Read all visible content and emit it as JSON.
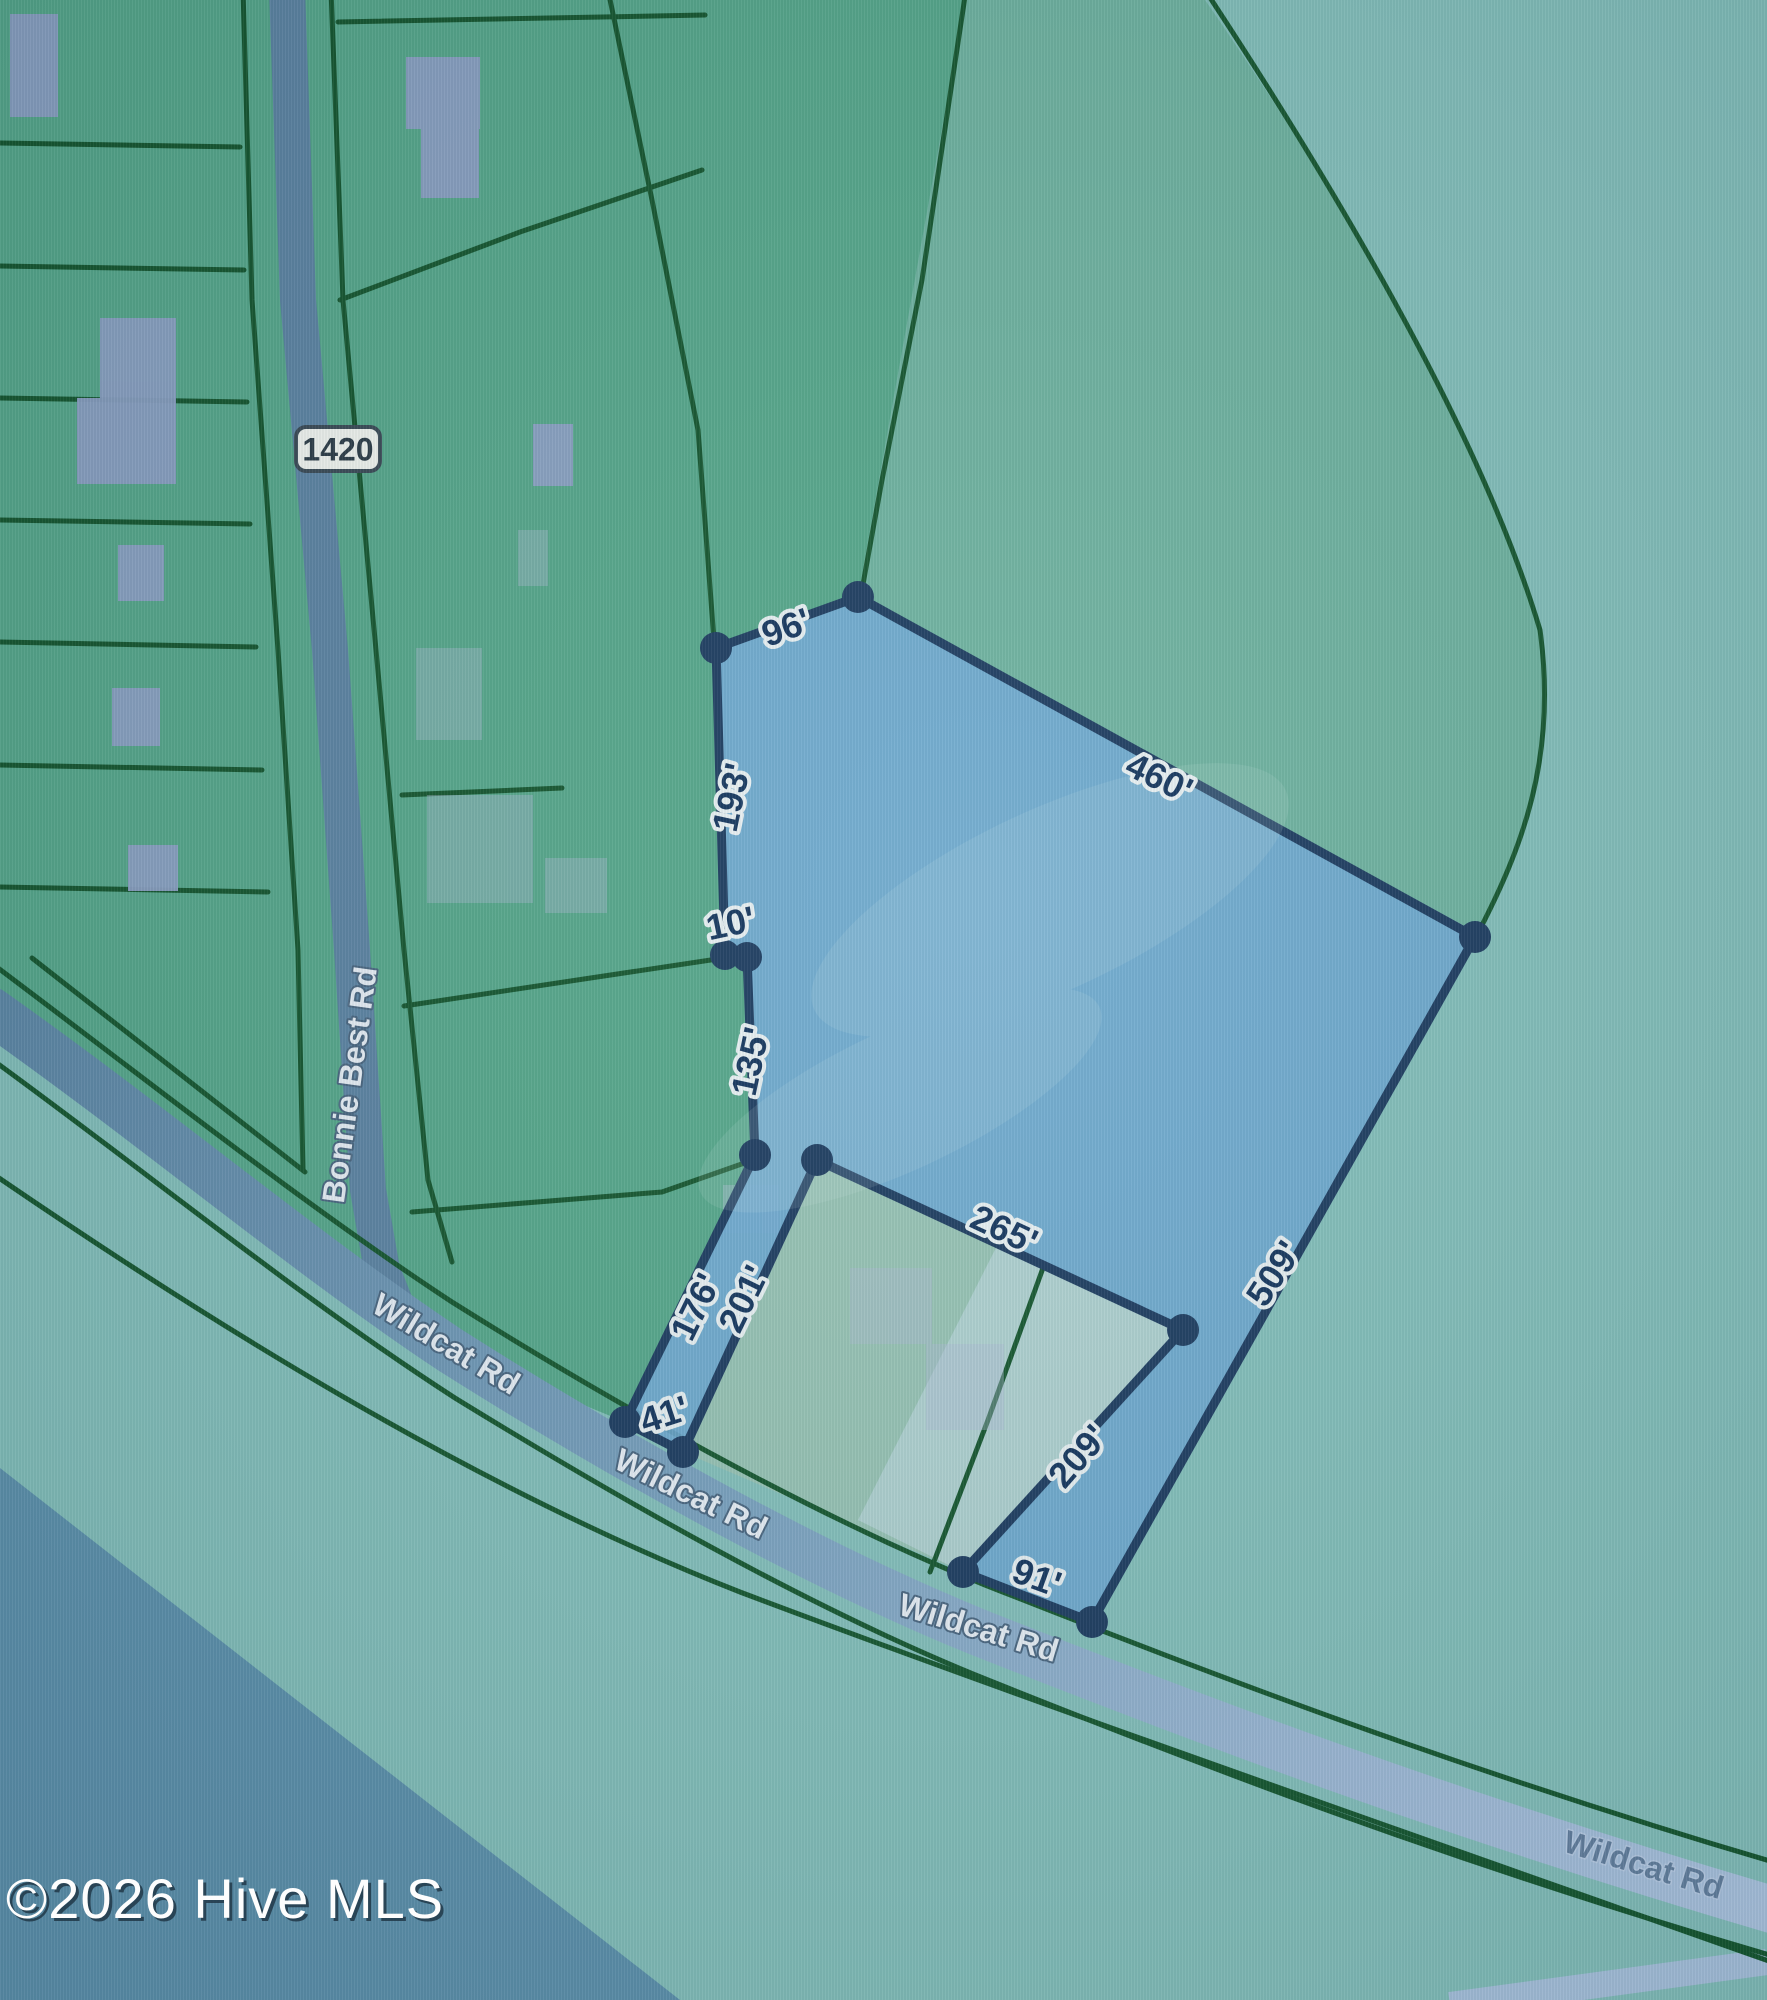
{
  "map": {
    "type": "gis-parcel-map",
    "watermark": "©2026 Hive MLS",
    "roads": {
      "bonnie_best": {
        "name": "Bonnie Best Rd",
        "route_badge": "1420"
      },
      "wildcat": {
        "name": "Wildcat Rd",
        "label_instances": 4
      }
    },
    "parcel": {
      "state": "selected-highlighted",
      "dimensions": [
        "96'",
        "460'",
        "193'",
        "10'",
        "135'",
        "176'",
        "201'",
        "41'",
        "265'",
        "209'",
        "91'",
        "509'"
      ]
    },
    "colors": {
      "parcel_fill": "#6ea8d2",
      "parcel_border": "#1d3c60",
      "parcel_green": "#56a88b",
      "parcel_green_teal": "#6fb3a0",
      "background_teal": "#84c0bb",
      "bottom_left_blue": "#5e92ad",
      "road_gray_blue": "#5d84a3",
      "road_light_blue": "#aec6e2",
      "boundary_green": "#15562e",
      "building_gray": "#8da1c5",
      "label_navy": "#14355d",
      "label_white": "#e8eff6"
    }
  }
}
